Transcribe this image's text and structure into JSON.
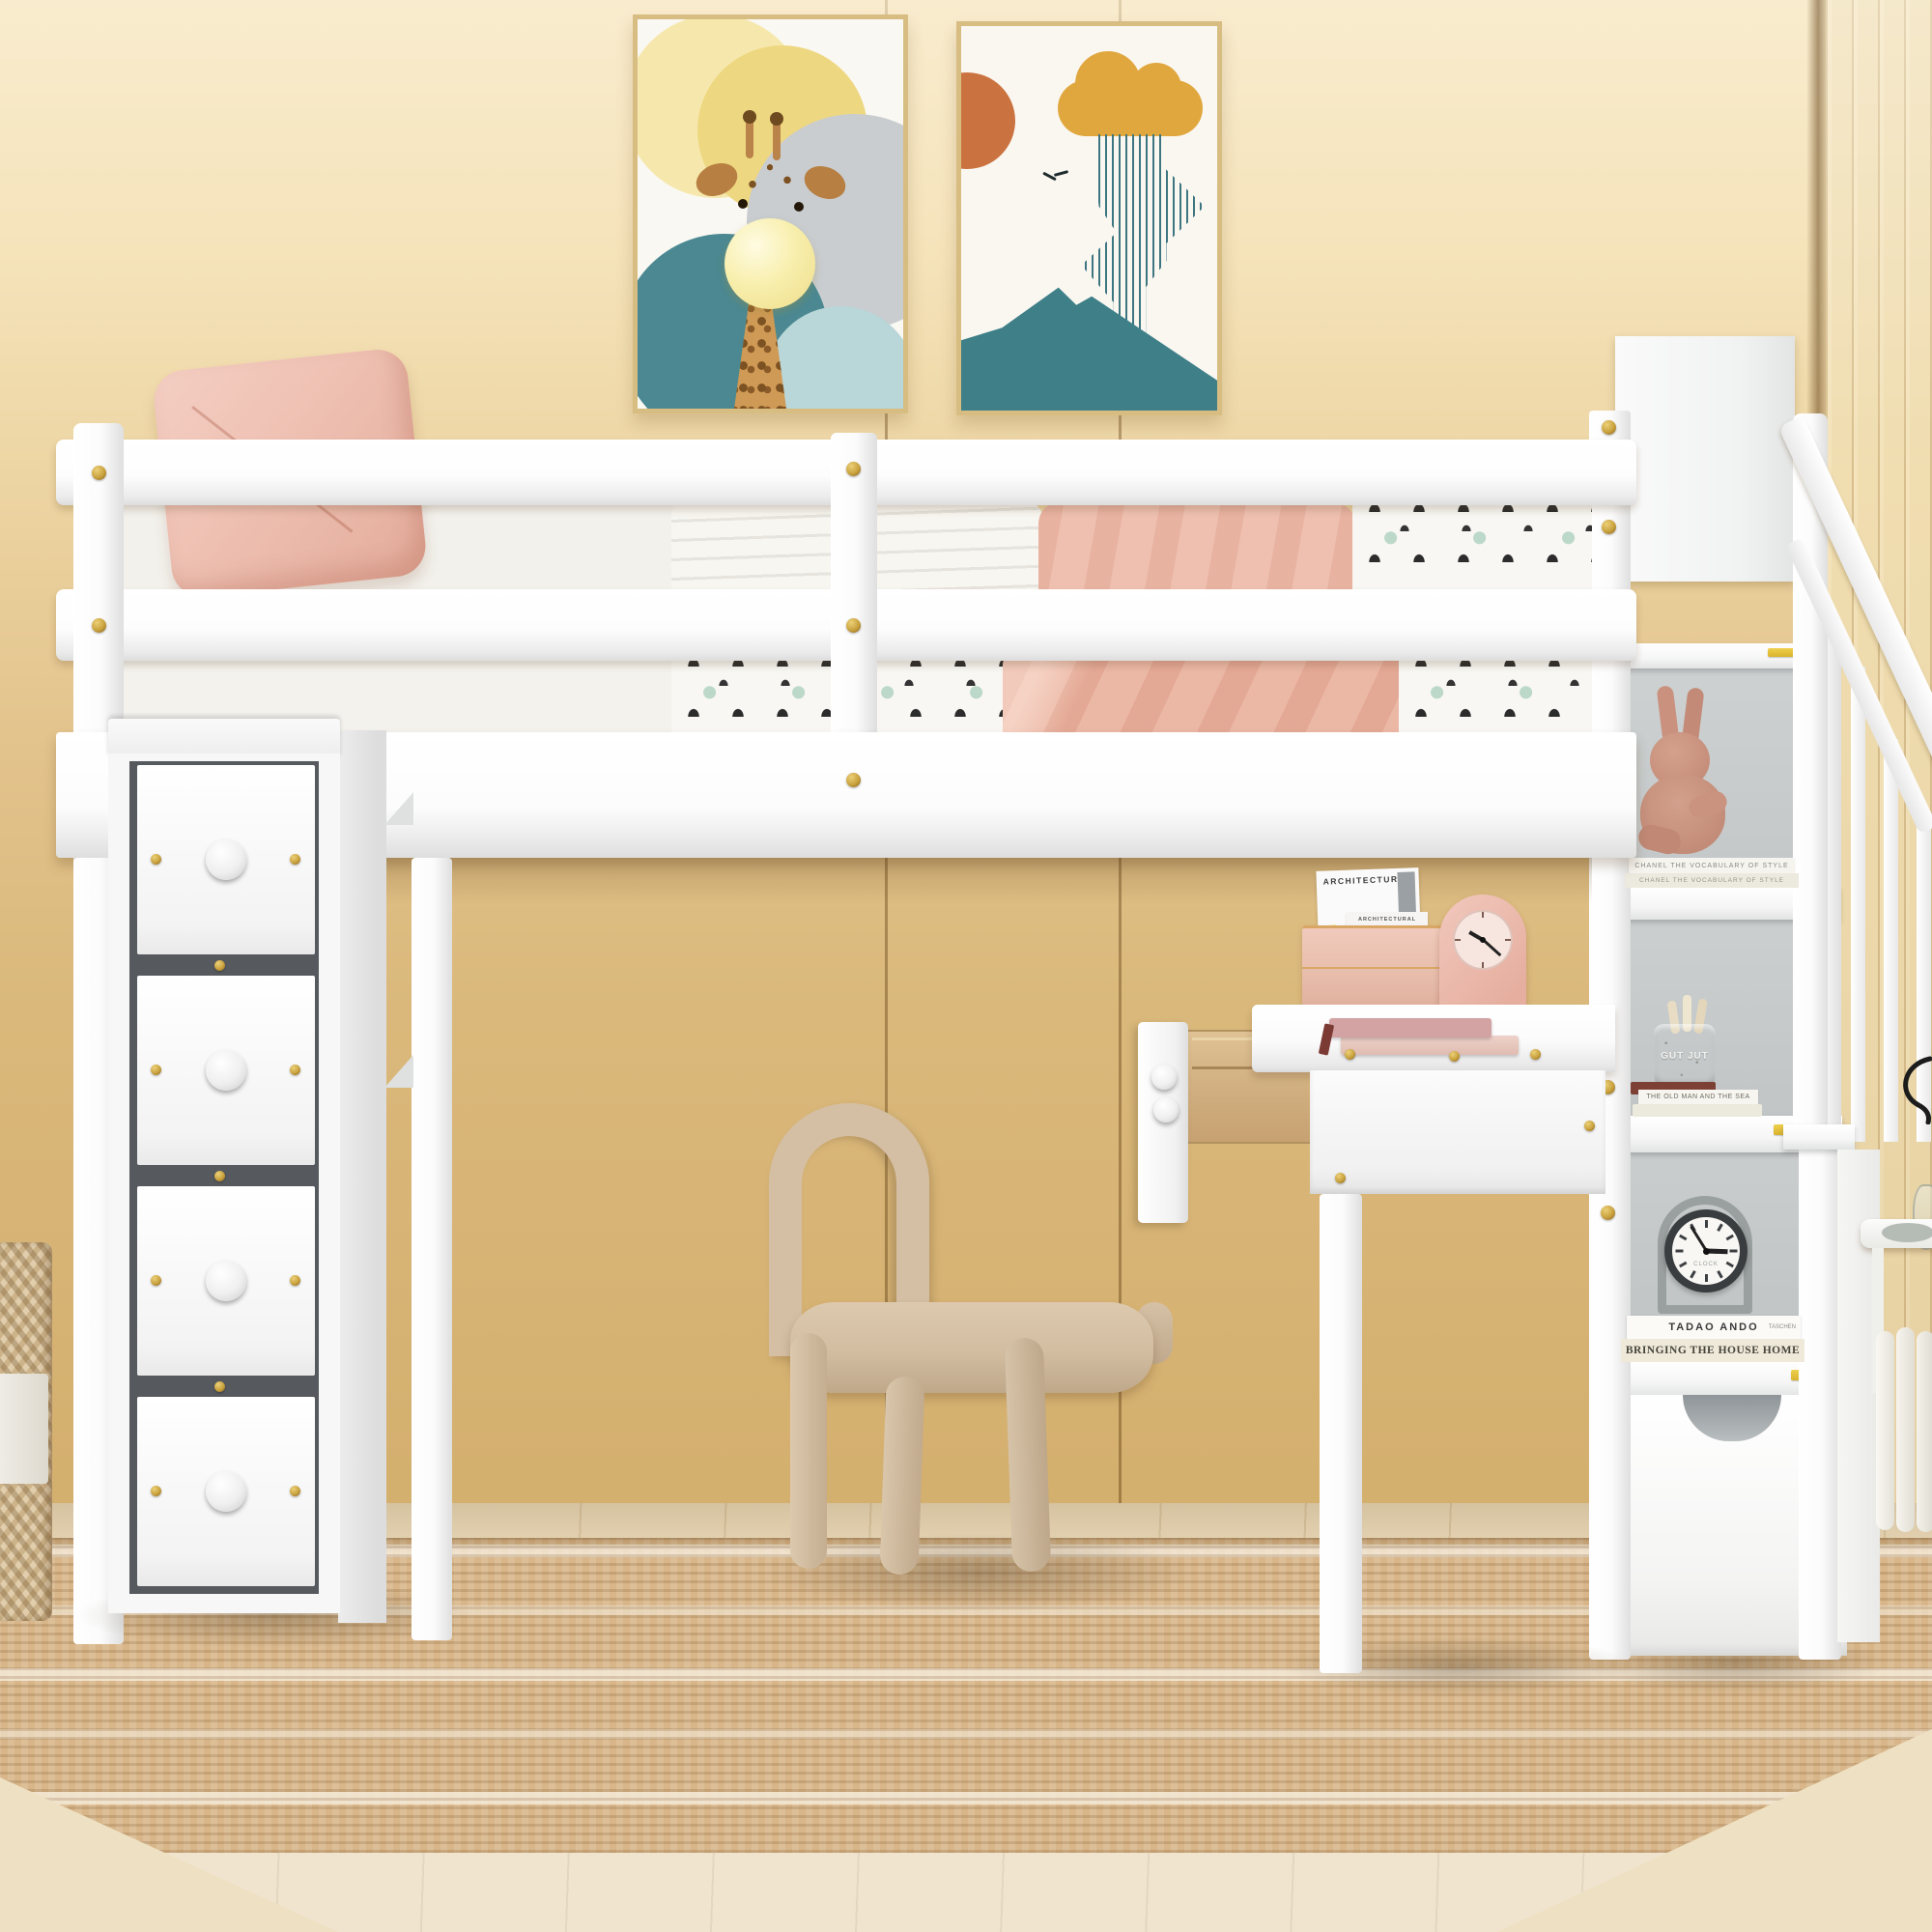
{
  "scene_text": {
    "magazine_large": "ARCHITECTURAL",
    "magazine_small": "ARCHITECTURAL",
    "bunny_book_top": "CHANEL  THE VOCABULARY OF STYLE",
    "bunny_book_bottom": "CHANEL  THE VOCABULARY OF STYLE",
    "pencil_jar": "GUT JUT",
    "old_man_book": "THE OLD MAN AND THE SEA",
    "clock_word": "CLOCK",
    "tadao_book": "TADAO ANDO",
    "tadao_publisher": "TASCHEN",
    "bringing_book": "BRINGING THE HOUSE HOME"
  },
  "clocks": {
    "shelf_clock_time": "2:55",
    "desk_clock_time": "10:22"
  },
  "colors": {
    "wall_top": "#f8e9c9",
    "wall_bottom": "#d3ae6c",
    "furniture_white": "#fafafa",
    "accent_gold": "#c9a23e",
    "textile_pink": "#efc0b2",
    "chair_beige": "#d3bea3",
    "shelf_back_gray": "#c7cbca",
    "drawer_recess_gray": "#565a5e",
    "art_teal": "#3d7680",
    "art_mustard": "#dfa63c",
    "art_orange": "#cc7440",
    "rug_tan": "#d8b689",
    "wood_floor": "#ead9ba"
  }
}
